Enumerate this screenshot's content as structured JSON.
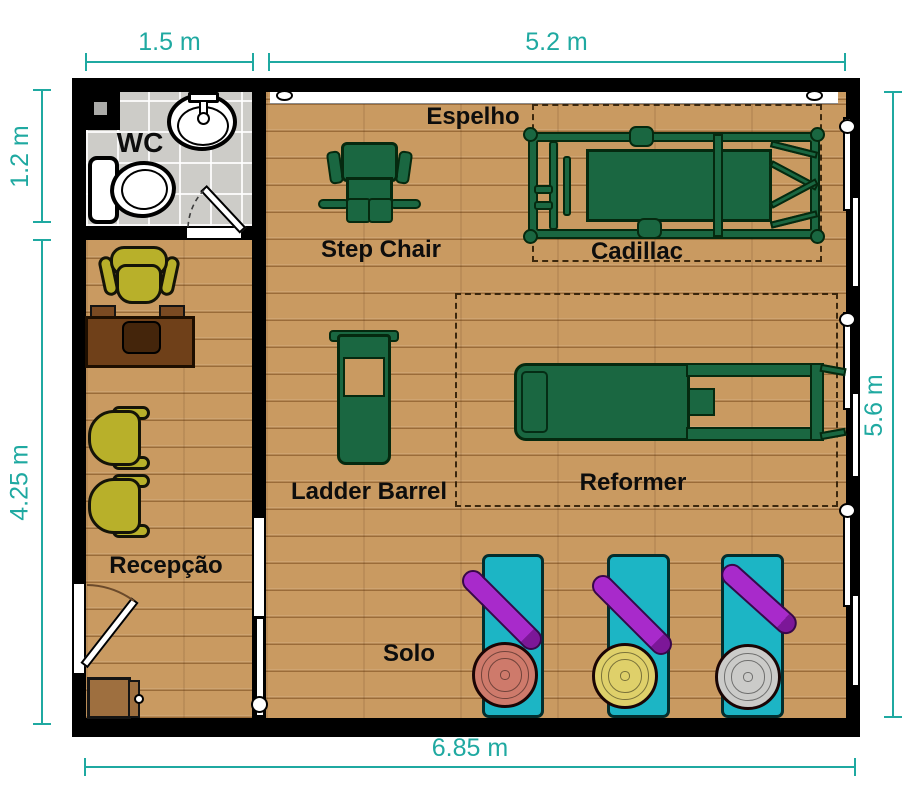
{
  "plan": {
    "type": "pilates-studio-floor-plan"
  },
  "dimensions": {
    "wc_width": "1.5 m",
    "studio_width": "5.2 m",
    "wc_height": "1.2 m",
    "reception_height": "4.25 m",
    "studio_height": "5.6 m",
    "total_width": "6.85 m"
  },
  "rooms": {
    "wc": {
      "label": "WC"
    },
    "reception": {
      "label": "Recepção"
    }
  },
  "equipment": {
    "mirror": {
      "label": "Espelho"
    },
    "step_chair": {
      "label": "Step Chair"
    },
    "cadillac": {
      "label": "Cadillac"
    },
    "ladder_barrel": {
      "label": "Ladder Barrel"
    },
    "reformer": {
      "label": "Reformer"
    },
    "solo": {
      "label": "Solo"
    }
  },
  "colors": {
    "dimension_teal": "#1FA9A1",
    "wall_black": "#000000",
    "wood_floor": "#C99A61",
    "tile_floor": "#CDCCC8",
    "equipment_green": "#1A6741",
    "chair_olive": "#B8B02A",
    "desk_brown": "#6F4019",
    "mat_teal": "#1CB5C5",
    "roller_purple": "#A82ACB",
    "disc_red": "#CE7A6B",
    "disc_yellow": "#DFD06A",
    "disc_gray": "#CBCBC9"
  }
}
